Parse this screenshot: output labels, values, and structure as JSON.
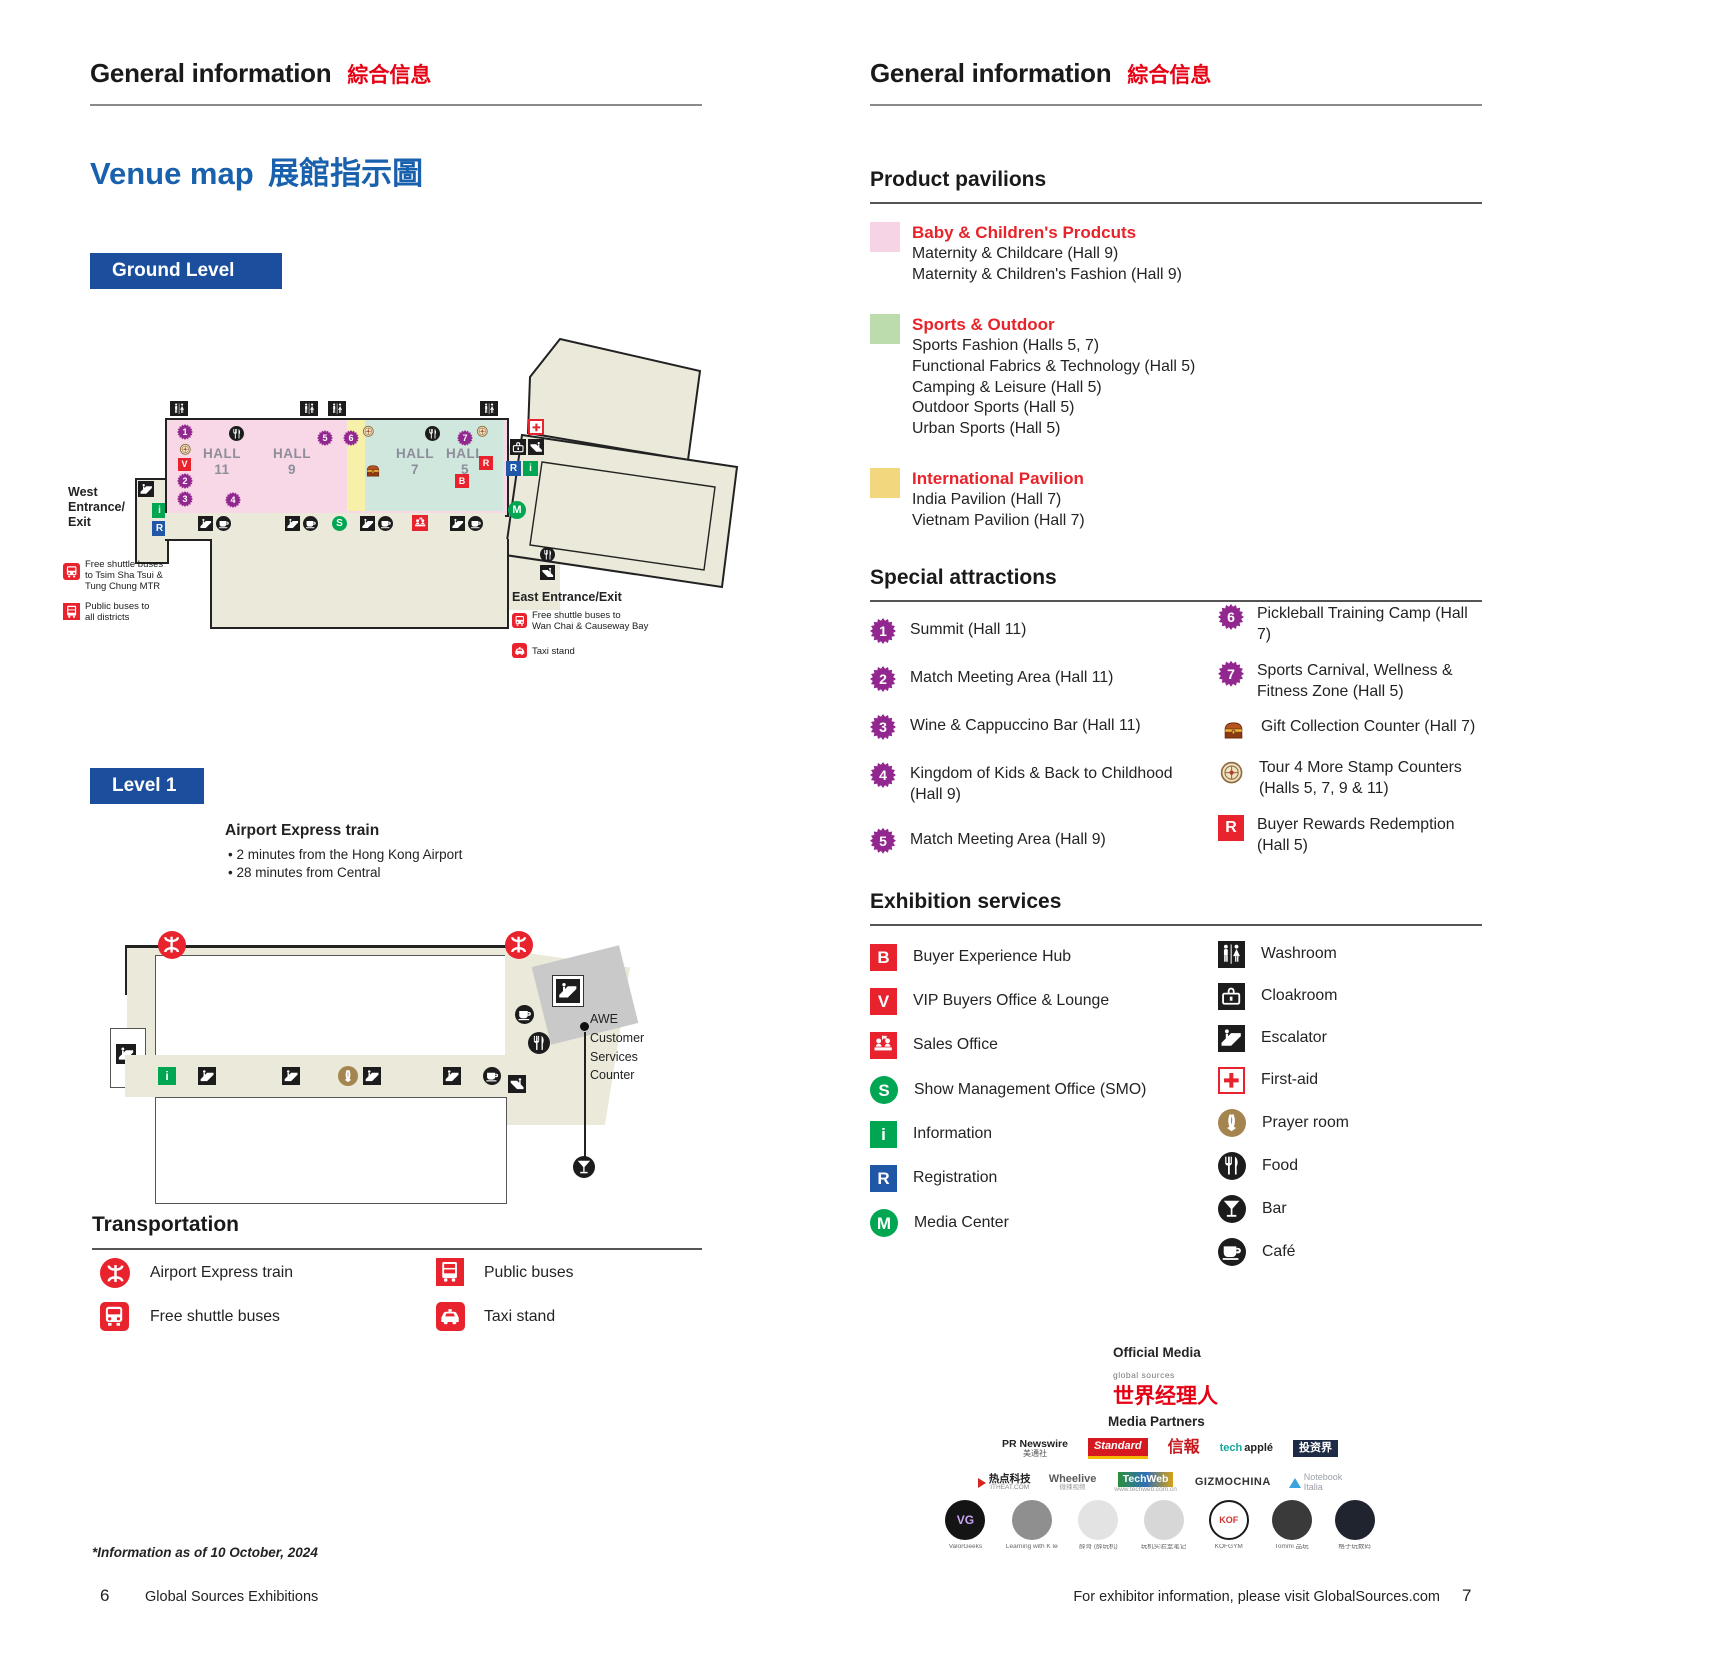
{
  "colors": {
    "accent_red": "#e60014",
    "icon_red": "#e8232e",
    "blue": "#1b4f9e",
    "reg_blue": "#2157a7",
    "green": "#00a651",
    "purple": "#92278f",
    "map_pink": "#f8d7e7",
    "map_sports_green": "#cfe7dc",
    "map_yellow": "#f6f0a8",
    "map_beige": "#eae9da",
    "swatch_pink": "#f6d3e5",
    "swatch_green": "#bcdcae",
    "swatch_yellow": "#f2d77f"
  },
  "glyphs": {
    "B": "B",
    "V": "V",
    "S": "S",
    "i": "i",
    "R": "R",
    "M": "M"
  },
  "left": {
    "header": {
      "title_en": "General information",
      "title_zh": "綜合信息"
    },
    "venue": {
      "en": "Venue map",
      "zh": "展館指示圖"
    },
    "ground_badge": "Ground Level",
    "level_badge": "Level 1",
    "map": {
      "halls": [
        {
          "name": "HALL",
          "num": "11"
        },
        {
          "name": "HALL",
          "num": "9"
        },
        {
          "name": "HALL",
          "num": "7"
        },
        {
          "name": "HALL",
          "num": "5"
        }
      ],
      "badge_nums": [
        "1",
        "2",
        "3",
        "4",
        "5",
        "6",
        "7"
      ],
      "west_label": "West\nEntrance/\nExit",
      "east_label": "East Entrance/Exit",
      "legend_west": [
        {
          "icon": "shuttle-bus",
          "text": "Free shuttle buses\nto Tsim Sha Tsui &\nTung Chung MTR"
        },
        {
          "icon": "public-bus",
          "text": "Public buses to\nall districts"
        }
      ],
      "legend_east": [
        {
          "icon": "shuttle-bus",
          "text": "Free shuttle buses to\nWan Chai & Causeway Bay"
        },
        {
          "icon": "taxi",
          "text": "Taxi stand"
        }
      ]
    },
    "airport": {
      "title": "Airport Express train",
      "bullets": [
        "•  2 minutes from the Hong Kong Airport",
        "•  28 minutes from Central"
      ]
    },
    "awe_label": "AWE\nCustomer\nServices\nCounter",
    "transportation": {
      "title": "Transportation",
      "items": [
        {
          "icon": "mtr",
          "label": "Airport Express train"
        },
        {
          "icon": "shuttle-bus",
          "label": "Free shuttle buses"
        },
        {
          "icon": "public-bus",
          "label": "Public buses"
        },
        {
          "icon": "taxi",
          "label": "Taxi stand"
        }
      ]
    },
    "footnote": "*Information as of 10 October, 2024",
    "footer": {
      "page": "6",
      "text": "Global Sources Exhibitions"
    }
  },
  "right": {
    "header": {
      "title_en": "General information",
      "title_zh": "綜合信息"
    },
    "pavilions": {
      "title": "Product pavilions",
      "groups": [
        {
          "name": "Baby & Children's Prodcuts",
          "items": [
            "Maternity & Childcare (Hall 9)",
            "Maternity & Children's Fashion (Hall 9)"
          ]
        },
        {
          "name": "Sports & Outdoor",
          "items": [
            "Sports Fashion (Halls 5, 7)",
            "Functional Fabrics & Technology (Hall 5)",
            "Camping & Leisure (Hall 5)",
            "Outdoor Sports (Hall 5)",
            "Urban Sports (Hall 5)"
          ]
        },
        {
          "name": "International Pavilion",
          "items": [
            "India Pavilion (Hall 7)",
            "Vietnam Pavilion (Hall 7)"
          ]
        }
      ]
    },
    "attractions": {
      "title": "Special attractions",
      "left": [
        {
          "num": "1",
          "text": "Summit (Hall 11)"
        },
        {
          "num": "2",
          "text": "Match Meeting Area (Hall 11)"
        },
        {
          "num": "3",
          "text": "Wine & Cappuccino Bar (Hall 11)"
        },
        {
          "num": "4",
          "text": "Kingdom of Kids & Back to Childhood (Hall 9)"
        },
        {
          "num": "5",
          "text": "Match Meeting Area (Hall 9)"
        }
      ],
      "right": [
        {
          "num": "6",
          "text": "Pickleball Training Camp (Hall 7)"
        },
        {
          "num": "7",
          "text": "Sports Carnival, Wellness & Fitness Zone (Hall 5)"
        },
        {
          "icon": "gift-chest",
          "text": "Gift Collection Counter (Hall 7)"
        },
        {
          "icon": "stamp",
          "text": "Tour 4 More Stamp Counters (Halls 5, 7, 9 & 11)"
        },
        {
          "icon": "buyer-rewards",
          "text": "Buyer Rewards Redemption (Hall 5)"
        }
      ]
    },
    "services": {
      "title": "Exhibition services",
      "left": [
        {
          "label": "Buyer Experience Hub"
        },
        {
          "label": "VIP Buyers Office & Lounge"
        },
        {
          "label": "Sales Office"
        },
        {
          "label": "Show Management Office (SMO)"
        },
        {
          "label": "Information"
        },
        {
          "label": "Registration"
        },
        {
          "label": "Media Center"
        }
      ],
      "right": [
        {
          "label": "Washroom"
        },
        {
          "label": "Cloakroom"
        },
        {
          "label": "Escalator"
        },
        {
          "label": "First-aid"
        },
        {
          "label": "Prayer room"
        },
        {
          "label": "Food"
        },
        {
          "label": "Bar"
        },
        {
          "label": "Café"
        }
      ]
    },
    "media": {
      "official_label": "Official Media",
      "brand_small": "global sources",
      "brand": "世界经理人",
      "partners_label": "Media Partners",
      "row1": [
        {
          "t1": "PR Newswire",
          "t2": "美通社"
        },
        {
          "t1": "Standard",
          "t2": "The"
        },
        {
          "t1": "信報",
          "t2": ""
        },
        {
          "t1": "tech",
          "t2": "applé"
        },
        {
          "t1": "投资界",
          "t2": ""
        }
      ],
      "row2": [
        {
          "t1": "热点科技",
          "t2": "ITHEAT.COM"
        },
        {
          "t1": "Wheelive",
          "t2": "微辣视频"
        },
        {
          "t1": "TechWeb",
          "t2": "www.techweb.com.cn"
        },
        {
          "t1": "GIZMOCHINA",
          "t2": ""
        },
        {
          "t1": "Notebook",
          "t2": "Italia"
        }
      ],
      "avatars": [
        {
          "mono": "VG",
          "cap": "ValorGeeks"
        },
        {
          "mono": "",
          "cap": "Learning with K lee"
        },
        {
          "mono": "",
          "cap": "薛哥 (薛玩机)"
        },
        {
          "mono": "",
          "cap": "玩机实验室笔记"
        },
        {
          "mono": "KOF",
          "cap": "KOFGYM"
        },
        {
          "mono": "",
          "cap": "Tommi 品玩"
        },
        {
          "mono": "",
          "cap": "格子玩数码"
        }
      ]
    },
    "footer": {
      "text": "For exhibitor information, please visit GlobalSources.com",
      "page": "7"
    }
  }
}
